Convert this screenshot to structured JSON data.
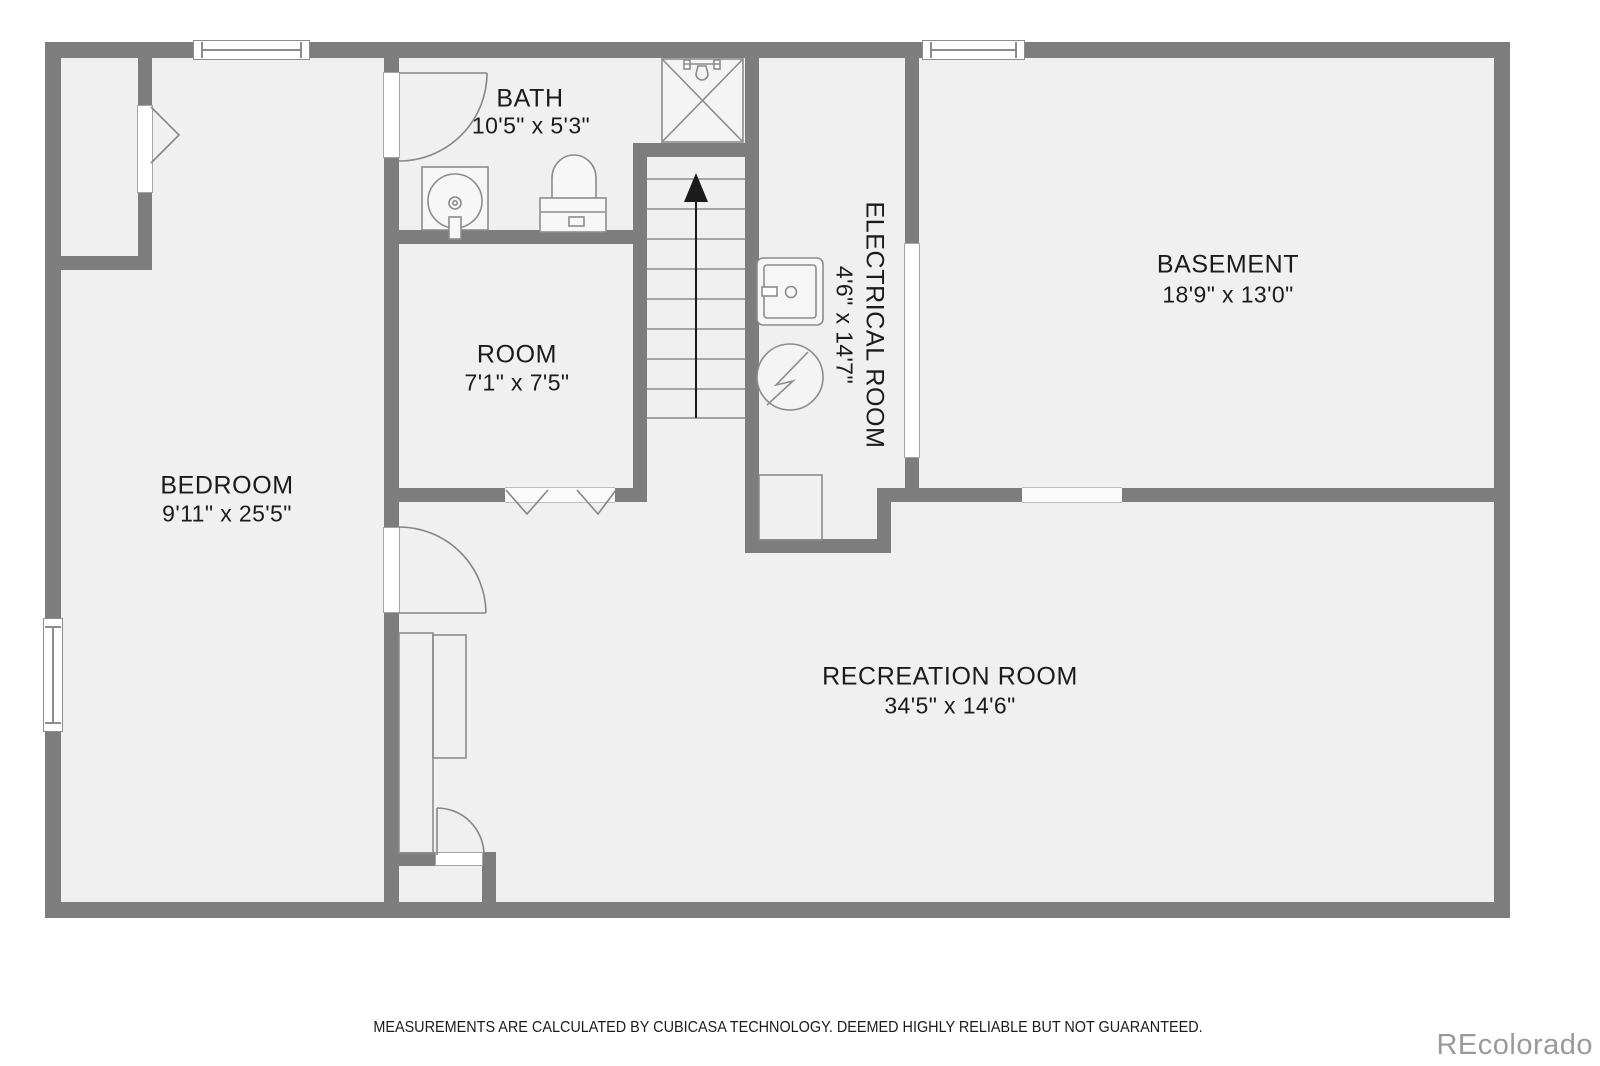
{
  "floorplan": {
    "rooms": {
      "bedroom": {
        "name": "BEDROOM",
        "dims": "9'11\" x 25'5\""
      },
      "bath": {
        "name": "BATH",
        "dims": "10'5\" x 5'3\""
      },
      "room": {
        "name": "ROOM",
        "dims": "7'1\" x 7'5\""
      },
      "electrical_room": {
        "name": "ELECTRICAL ROOM",
        "dims": "4'6\" x 14'7\""
      },
      "basement": {
        "name": "BASEMENT",
        "dims": "18'9\" x 13'0\""
      },
      "recreation_room": {
        "name": "RECREATION ROOM",
        "dims": "34'5\" x 14'6\""
      }
    },
    "symbols": [
      "stairs-up-arrow",
      "shower",
      "toilet",
      "pedestal-sink",
      "utility-sink",
      "electrical-panel",
      "door-swing",
      "bifold-door",
      "double-door",
      "window",
      "wardrobe",
      "understair-storage"
    ],
    "colors": {
      "wall": "#7d7d7d",
      "floor": "#f0f0f0",
      "fixture_line": "#8c8c8c",
      "label_text": "#1b1b1b",
      "watermark": "#9a9a9a",
      "background": "#ffffff"
    }
  },
  "footer": {
    "disclaimer": "MEASUREMENTS ARE CALCULATED BY CUBICASA TECHNOLOGY. DEEMED HIGHLY RELIABLE BUT NOT GUARANTEED."
  },
  "watermark": {
    "text": "REcolorado"
  }
}
